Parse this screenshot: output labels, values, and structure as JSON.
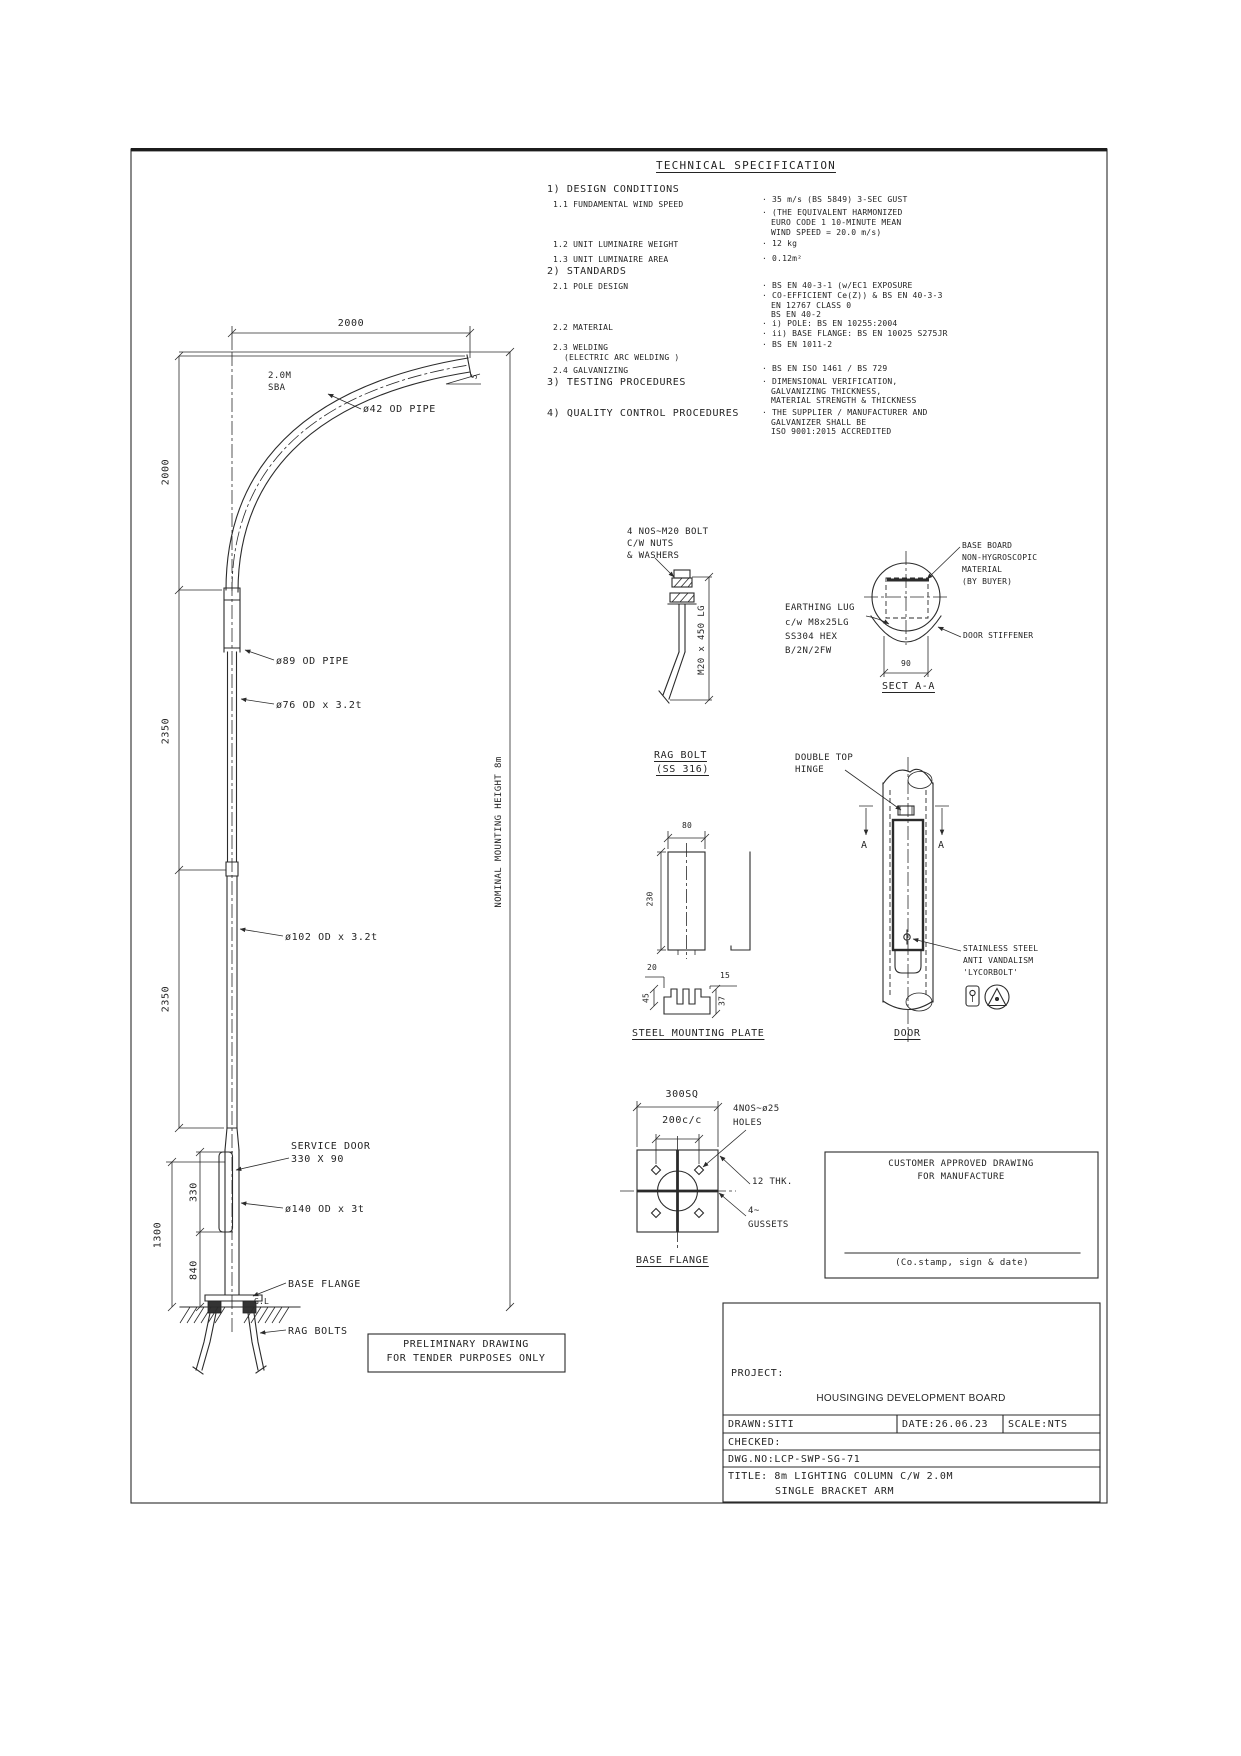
{
  "meta": {
    "ink_color": "#2b2b2b",
    "paper_color": "#ffffff"
  },
  "spec": {
    "title": "TECHNICAL SPECIFICATION",
    "h1": "1) DESIGN CONDITIONS",
    "r11": "1.1 FUNDAMENTAL WIND SPEED",
    "r11v1": "· 35 m/s (BS 5849) 3-SEC GUST",
    "r11v2": "· (THE EQUIVALENT HARMONIZED",
    "r11v3": "EURO CODE 1 10-MINUTE MEAN",
    "r11v4": "WIND SPEED = 20.0 m/s)",
    "r12": "1.2 UNIT LUMINAIRE WEIGHT",
    "r12v": "· 12 kg",
    "r13": "1.3 UNIT LUMINAIRE AREA",
    "r13v": "· 0.12m²",
    "h2": "2) STANDARDS",
    "r21": "2.1 POLE DESIGN",
    "r21v1": "· BS EN 40-3-1 (w/EC1 EXPOSURE",
    "r21v2": "· CO-EFFICIENT Ce(Z)) & BS EN 40-3-3",
    "r21v3": "EN 12767 CLASS 0",
    "r21v4": "BS EN 40-2",
    "r22": "2.2 MATERIAL",
    "r22v1": "· i) POLE: BS EN 10255:2004",
    "r22v2": "· ii) BASE FLANGE: BS EN 10025 S275JR",
    "r23a": "2.3 WELDING",
    "r23b": "(ELECTRIC ARC WELDING )",
    "r23v": "· BS EN 1011-2",
    "r24": "2.4 GALVANIZING",
    "r24v": "· BS EN ISO 1461 / BS 729",
    "h3": "3) TESTING PROCEDURES",
    "r3v1": "· DIMENSIONAL VERIFICATION,",
    "r3v2": "GALVANIZING THICKNESS,",
    "r3v3": "MATERIAL STRENGTH & THICKNESS",
    "h4": "4) QUALITY CONTROL PROCEDURES",
    "r4v1": "· THE SUPPLIER / MANUFACTURER AND",
    "r4v2": "GALVANIZER SHALL BE",
    "r4v3": "ISO 9001:2015 ACCREDITED"
  },
  "pole": {
    "dim_top": "2000",
    "sba1": "2.0M",
    "sba2": "SBA",
    "tip_angle": "5",
    "arm_pipe": "ø42 OD PIPE",
    "dim_2000": "2000",
    "dim_2350a": "2350",
    "dim_2350b": "2350",
    "dim_1300": "1300",
    "dim_330": "330",
    "dim_840": "840",
    "nominal": "NOMINAL MOUNTING HEIGHT 8m",
    "p89": "ø89 OD PIPE",
    "p76": "ø76 OD x 3.2t",
    "p102": "ø102 OD x 3.2t",
    "door1": "SERVICE DOOR",
    "door2": "330 X 90",
    "p140": "ø140 OD x 3t",
    "flange": "BASE FLANGE",
    "gl": "G.L",
    "ragbolts": "RAG BOLTS"
  },
  "ragbolt": {
    "c1": "4 NOS~M20 BOLT",
    "c2": "C/W NUTS",
    "c3": "& WASHERS",
    "dim": "M20 x 450 LG",
    "t1": "RAG BOLT",
    "t2": "(SS 316)"
  },
  "sect": {
    "bb1": "BASE BOARD",
    "bb2": "NON-HYGROSCOPIC",
    "bb3": "MATERIAL",
    "bb4": "(BY BUYER)",
    "el1": "EARTHING LUG",
    "el2": "c/w M8x25LG",
    "el3": "SS304 HEX",
    "el4": "B/2N/2FW",
    "stiff": "DOOR STIFFENER",
    "dim90": "90",
    "title": "SECT A-A"
  },
  "door": {
    "h1": "DOUBLE TOP",
    "h2": "HINGE",
    "a_left": "A",
    "a_right": "A",
    "s1": "STAINLESS STEEL",
    "s2": "ANTI VANDALISM",
    "s3": "'LYCORBOLT'",
    "title": "DOOR"
  },
  "plate": {
    "d80": "80",
    "d230": "230",
    "d20": "20",
    "d15": "15",
    "d45": "45",
    "d37": "37",
    "title": "STEEL MOUNTING PLATE"
  },
  "flange": {
    "d300": "300SQ",
    "d200": "200c/c",
    "holes1": "4NOS~ø25",
    "holes2": "HOLES",
    "thk": "12 THK.",
    "g1": "4~",
    "g2": "GUSSETS",
    "title": "BASE FLANGE"
  },
  "customer": {
    "l1": "CUSTOMER APPROVED DRAWING",
    "l2": "FOR MANUFACTURE",
    "sign": "(Co.stamp, sign & date)"
  },
  "prelim": {
    "l1": "PRELIMINARY DRAWING",
    "l2": "FOR TENDER PURPOSES ONLY"
  },
  "tb": {
    "project_label": "PROJECT:",
    "project_value": "HOUSINGING DEVELOPMENT BOARD",
    "drawn": "DRAWN:SITI",
    "date": "DATE:26.06.23",
    "scale": "SCALE:NTS",
    "checked": "CHECKED:",
    "dwg_no": "DWG.NO:LCP-SWP-SG-71",
    "title1": "TITLE: 8m LIGHTING COLUMN C/W 2.0M",
    "title2": "SINGLE BRACKET ARM"
  }
}
